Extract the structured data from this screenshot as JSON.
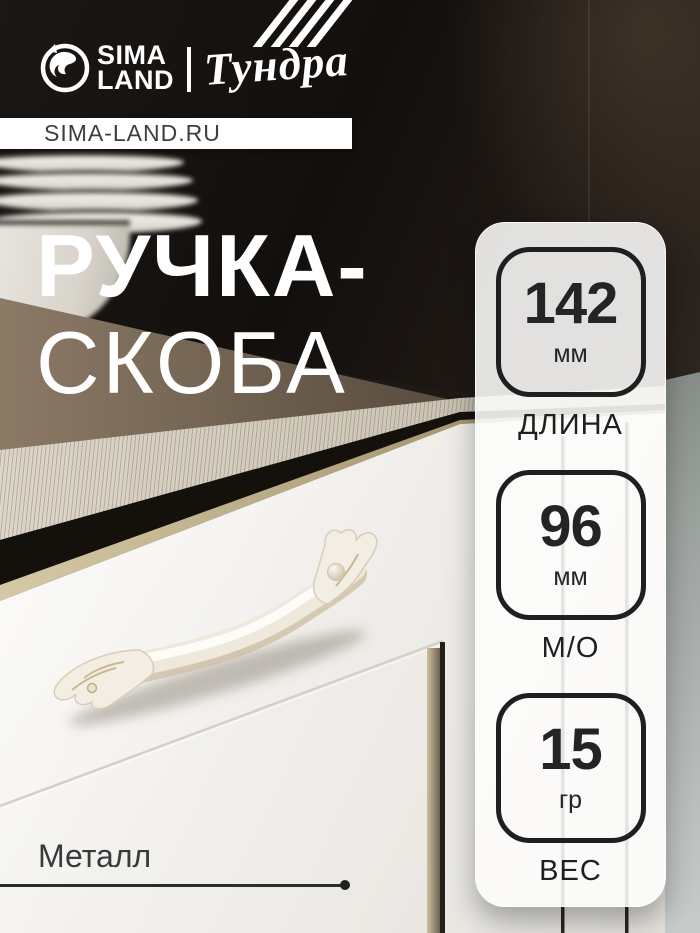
{
  "brand": {
    "sima_line1": "SIMA",
    "sima_line2": "LAND",
    "tundra": "Тундра"
  },
  "header_strip": {
    "text": "SIMA-LAND.RU"
  },
  "title": {
    "line1": "РУЧКА-",
    "line2": "СКОБА"
  },
  "specs": [
    {
      "value": "142",
      "unit": "мм",
      "label": "ДЛИНА"
    },
    {
      "value": "96",
      "unit": "мм",
      "label": "М/О"
    },
    {
      "value": "15",
      "unit": "гр",
      "label": "ВЕС"
    }
  ],
  "material": "Металл",
  "colors": {
    "badge_outline": "#1f1f1f",
    "badge_panel_bg": "rgba(253,253,252,0.88)",
    "brand_white": "#ffffff",
    "strip_text": "#3e3e40",
    "material_text": "#3a3a3c"
  }
}
